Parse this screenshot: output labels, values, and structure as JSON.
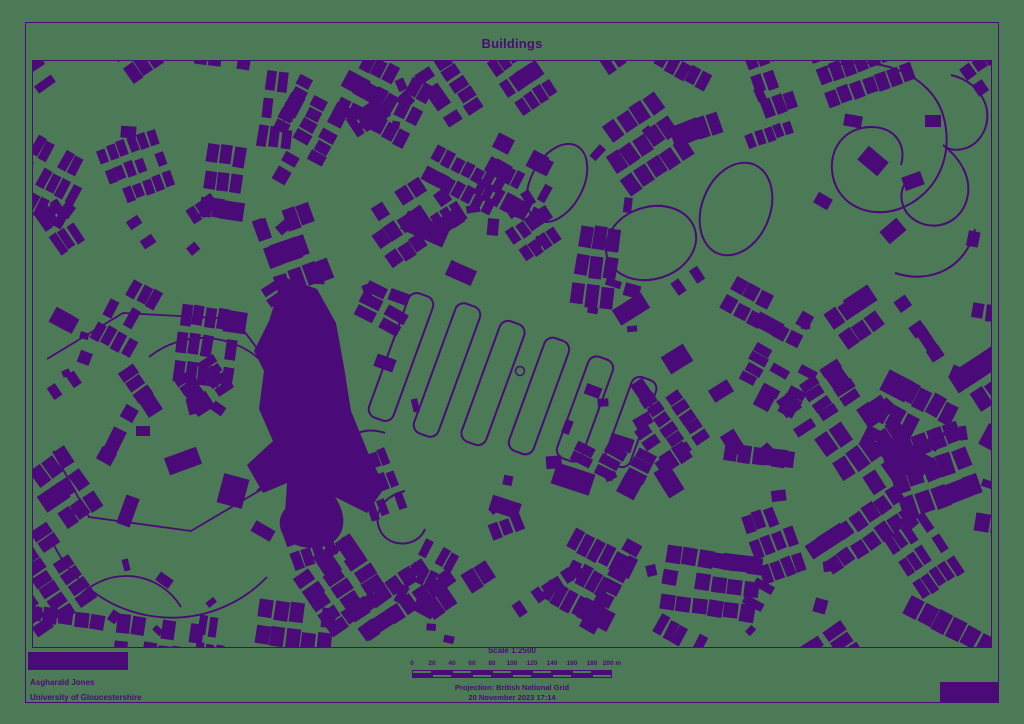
{
  "colors": {
    "background": "#4d7a56",
    "ink": "#4a0a78"
  },
  "title": "Buildings",
  "footer": {
    "author_line1": "Asgharald Jones",
    "author_line2": "University of Gloucestershire",
    "scale_title": "Scale 1:2500",
    "scalebar_labels": [
      "0",
      "20",
      "40",
      "60",
      "80",
      "100",
      "120",
      "140",
      "160",
      "180",
      "200 m"
    ],
    "projection": "Projection: British National Grid",
    "datetime": "20 November 2023 17:14"
  }
}
